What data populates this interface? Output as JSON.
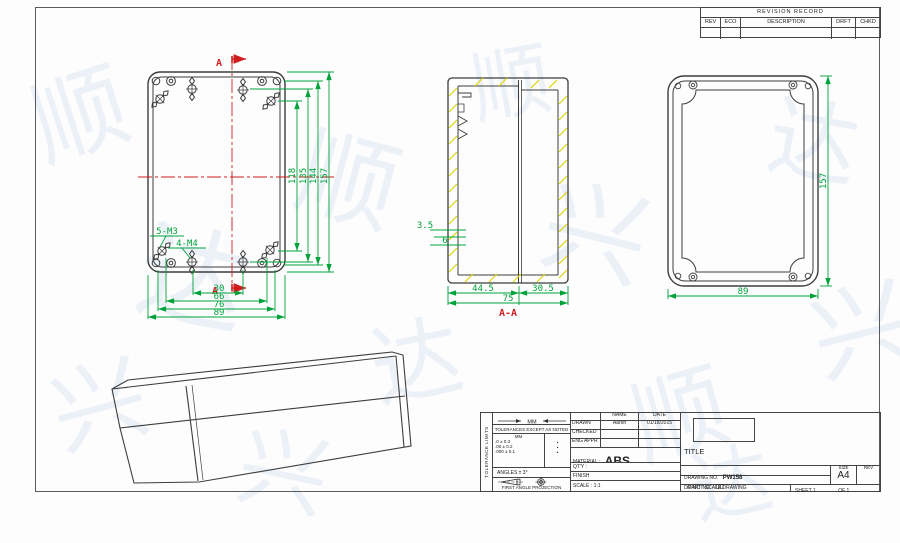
{
  "watermark": {
    "chars": [
      "顺",
      "达",
      "兴",
      "顺",
      "达",
      "兴",
      "顺",
      "达",
      "兴",
      "顺",
      "兴",
      "达"
    ]
  },
  "revision_table": {
    "title": "REVISION RECORD",
    "columns": [
      "REV",
      "ECO",
      "DESCRIPTION",
      "DRFT",
      "CHKD"
    ]
  },
  "views": {
    "front": {
      "section_label": "A",
      "v_dims": [
        "118",
        "135",
        "144",
        "157"
      ],
      "h_dims": [
        "30",
        "66",
        "76",
        "89"
      ],
      "m3_label": "5-M3",
      "m4_label": "4-M4"
    },
    "section": {
      "label": "A-A",
      "d1": "3.5",
      "d2": "6",
      "w1": "44.5",
      "w2": "30.5",
      "w_total": "75"
    },
    "back": {
      "height": "157",
      "width": "89"
    }
  },
  "title_block": {
    "side_label": "TOLERANCE LIMITS",
    "mm_note": "MM",
    "tolerance_title": "TOLERANCES EXCEPT AS NOTED",
    "mm_header": "MM",
    "tol_rows": [
      ".0 ± 0.3",
      ".00 ± 0.2",
      ".000 ± 0.1"
    ],
    "tol_syms": [
      "•",
      "•",
      "•"
    ],
    "angles": "ANGLES ± 3°",
    "projection": "FIRST ANGLE PROJECTION",
    "name_header": "NAME",
    "date_header": "DATE",
    "drawn_label": "DRAWN",
    "drawn_name": "Aaron",
    "drawn_date": "01/18/2015",
    "checked_label": "CHECKED",
    "eng_appr_label": "ENG APPR",
    "material_label": "MATERIAL :",
    "material_value": "ABS",
    "qty_label": "QT'Y :",
    "finish_label": "FINISH",
    "scale_label": "SCALE : 1:1",
    "title_label": "TITLE",
    "drawing_no_label": "DRAWING NO.",
    "drawing_no": "PW158",
    "part_no_label": "/PART NO.",
    "part_no": "00",
    "size_label": "SIZE",
    "size_value": "A4",
    "rev_label": "REV",
    "do_not_scale": "DO NOT SCALE DRAWING",
    "sheet_label": "SHEET 1",
    "of_label": "OF 1"
  },
  "colors": {
    "dimension_green": "#00a33a",
    "centerline_red": "#cf1d1d",
    "hatch_yellow": "#ddd400",
    "outline": "#3d3d3d",
    "watermark_blue": "#7da2d0"
  }
}
